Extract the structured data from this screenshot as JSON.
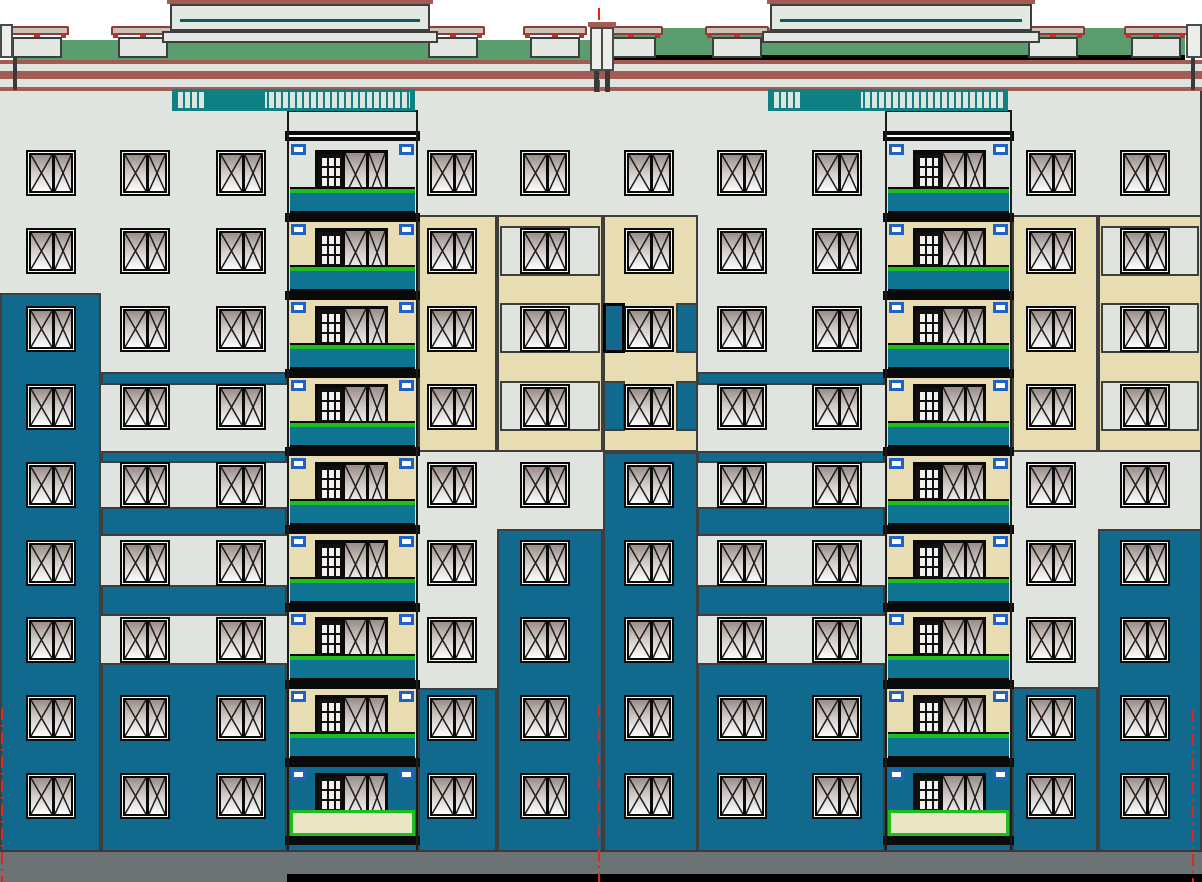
{
  "title": "Nine-storey residential building facade elevation (CAD drawing)",
  "canvas": {
    "w": 1202,
    "h": 882
  },
  "colors": {
    "sky": "#ffffff",
    "facade": "#dfe4de",
    "beige": "#e8ddb2",
    "teal": "#11698e",
    "panel_teal": "#0f7392",
    "roof_green": "#5a9e70",
    "rail_teal": "#0e8184",
    "bulkhead_teal": "#0b5d5e",
    "cornice": "#a25c54",
    "vent_cap": "#cbc3bb",
    "vent_cap_edge": "#8c3c34",
    "vent_red": "#c03227",
    "slab": "#0a0a0a",
    "green_line": "#1fbe1f",
    "clip_blue": "#1e62c8",
    "base": "#6d7275",
    "outline": "#3e3e3e",
    "dark_edge": "#1c1c1c",
    "axis_red": "#e1251b",
    "window_frame": "#0a0a0a",
    "r9_rail": "#eae5c4",
    "post_fill": "#eceeea",
    "ground": "#000000"
  },
  "roof": {
    "green_bands": [
      {
        "x": 13,
        "y": 40,
        "w": 585,
        "h": 20
      },
      {
        "x": 604,
        "y": 28,
        "w": 581,
        "h": 34
      }
    ],
    "black_line": {
      "x": 604,
      "y": 55,
      "w": 581,
      "h": 8
    },
    "bulkheads": [
      {
        "x": 170,
        "w": 260
      },
      {
        "x": 770,
        "w": 262
      }
    ],
    "vent_w": 50,
    "vents": [
      {
        "x": 12
      },
      {
        "x": 118
      },
      {
        "x": 428
      },
      {
        "x": 530
      },
      {
        "x": 606
      },
      {
        "x": 712
      },
      {
        "x": 1028
      },
      {
        "x": 1131
      }
    ],
    "cornice_bands": [
      {
        "y": 60,
        "h": 4
      },
      {
        "y": 71,
        "h": 8
      },
      {
        "y": 87,
        "h": 4
      }
    ],
    "railings": [
      {
        "x": 172,
        "w": 243
      },
      {
        "x": 768,
        "w": 240
      }
    ],
    "center_post": {
      "x": 590,
      "w": 24
    },
    "edge_posts": [
      {
        "x": 0,
        "w": 13,
        "side": "left"
      },
      {
        "x": 1186,
        "w": 16,
        "side": "right"
      }
    ]
  },
  "facade": {
    "base": {
      "x": 0,
      "y": 63,
      "w": 1202,
      "h": 789
    },
    "right_edge": {
      "x": 1200,
      "y": 91,
      "w": 2,
      "h": 761
    },
    "panels": [
      {
        "x": 0,
        "y": 293,
        "w": 101,
        "h": 559,
        "c": "teal"
      },
      {
        "x": 101,
        "y": 372,
        "w": 186,
        "h": 13,
        "c": "teal"
      },
      {
        "x": 101,
        "y": 451,
        "w": 186,
        "h": 12,
        "c": "teal"
      },
      {
        "x": 101,
        "y": 507,
        "w": 186,
        "h": 29,
        "c": "teal"
      },
      {
        "x": 101,
        "y": 585,
        "w": 186,
        "h": 31,
        "c": "teal"
      },
      {
        "x": 101,
        "y": 663,
        "w": 186,
        "h": 189,
        "c": "teal"
      },
      {
        "x": 418,
        "y": 215,
        "w": 79,
        "h": 237,
        "c": "beige"
      },
      {
        "x": 497,
        "y": 215,
        "w": 106,
        "h": 237,
        "c": "beige"
      },
      {
        "x": 500,
        "y": 226,
        "w": 100,
        "h": 50,
        "c": "gray"
      },
      {
        "x": 500,
        "y": 303,
        "w": 100,
        "h": 50,
        "c": "gray"
      },
      {
        "x": 500,
        "y": 381,
        "w": 100,
        "h": 50,
        "c": "gray"
      },
      {
        "x": 603,
        "y": 215,
        "w": 95,
        "h": 237,
        "c": "beige"
      },
      {
        "x": 603,
        "y": 303,
        "w": 22,
        "h": 50,
        "c": "teal",
        "heavy": 1
      },
      {
        "x": 676,
        "y": 303,
        "w": 22,
        "h": 50,
        "c": "teal"
      },
      {
        "x": 603,
        "y": 381,
        "w": 22,
        "h": 50,
        "c": "teal"
      },
      {
        "x": 676,
        "y": 381,
        "w": 22,
        "h": 50,
        "c": "teal"
      },
      {
        "x": 603,
        "y": 452,
        "w": 95,
        "h": 400,
        "c": "teal"
      },
      {
        "x": 497,
        "y": 529,
        "w": 106,
        "h": 323,
        "c": "teal"
      },
      {
        "x": 418,
        "y": 688,
        "w": 79,
        "h": 164,
        "c": "teal"
      },
      {
        "x": 697,
        "y": 372,
        "w": 188,
        "h": 13,
        "c": "teal"
      },
      {
        "x": 697,
        "y": 451,
        "w": 188,
        "h": 12,
        "c": "teal"
      },
      {
        "x": 697,
        "y": 507,
        "w": 188,
        "h": 29,
        "c": "teal"
      },
      {
        "x": 697,
        "y": 585,
        "w": 188,
        "h": 31,
        "c": "teal"
      },
      {
        "x": 697,
        "y": 663,
        "w": 188,
        "h": 189,
        "c": "teal"
      },
      {
        "x": 1012,
        "y": 215,
        "w": 86,
        "h": 237,
        "c": "beige"
      },
      {
        "x": 1098,
        "y": 215,
        "w": 104,
        "h": 237,
        "c": "beige"
      },
      {
        "x": 1101,
        "y": 226,
        "w": 98,
        "h": 50,
        "c": "gray"
      },
      {
        "x": 1101,
        "y": 303,
        "w": 98,
        "h": 50,
        "c": "gray"
      },
      {
        "x": 1101,
        "y": 381,
        "w": 98,
        "h": 50,
        "c": "gray"
      },
      {
        "x": 1098,
        "y": 529,
        "w": 104,
        "h": 323,
        "c": "teal"
      },
      {
        "x": 1012,
        "y": 687,
        "w": 86,
        "h": 165,
        "c": "teal"
      }
    ],
    "window_cols": [
      26,
      120,
      216,
      427,
      520,
      624,
      717,
      812,
      1026,
      1120
    ],
    "window_rows": [
      150,
      228,
      306,
      384,
      462,
      540,
      617,
      695,
      773
    ],
    "window": {
      "w": 50,
      "h": 46
    }
  },
  "balconies": {
    "columns": [
      {
        "x": 287,
        "w": 131
      },
      {
        "x": 885,
        "w": 127
      }
    ],
    "wall_beige": {
      "from": 215,
      "to": 758
    },
    "wall_teal": {
      "from": 758,
      "to": 852
    },
    "top_slab_y": 131,
    "top_clip_y": 144,
    "unit": {
      "dx": 28,
      "w": 73,
      "h": 55
    },
    "railing": {
      "dy": 37,
      "h": 26
    },
    "slab": {
      "dy": 63,
      "h": 9
    },
    "clip": {
      "dy": 74,
      "w": 15,
      "h": 11
    }
  },
  "base_strip": {
    "x": 0,
    "y": 850,
    "w": 1202,
    "h": 32
  },
  "ground_line": {
    "x": 287,
    "y": 874,
    "w": 915,
    "h": 8
  },
  "axis_lines": [
    {
      "x": 598,
      "y1": 8,
      "y2": 92,
      "zone": "roof-center"
    },
    {
      "x": 598,
      "y1": 705,
      "y2": 882,
      "zone": "base-center"
    },
    {
      "x": 1,
      "y1": 708,
      "y2": 882,
      "zone": "base-left"
    },
    {
      "x": 1192,
      "y1": 710,
      "y2": 882,
      "zone": "base-right"
    }
  ]
}
